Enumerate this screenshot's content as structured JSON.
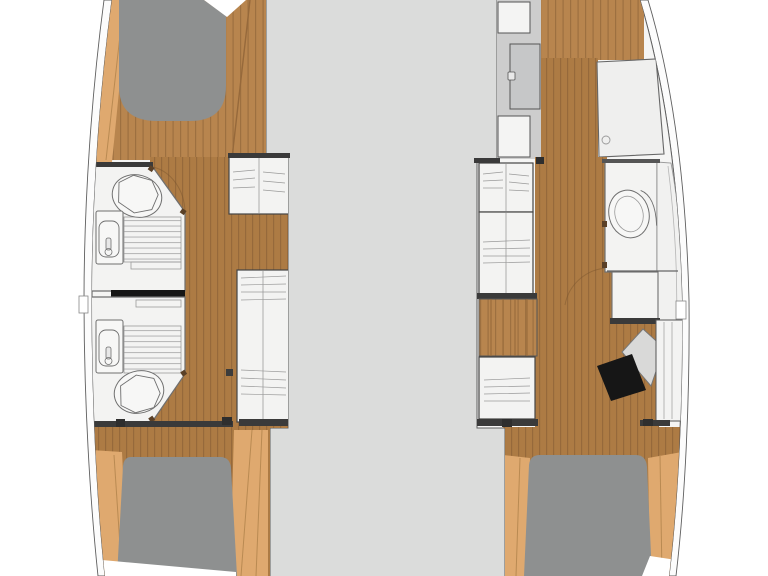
{
  "document": {
    "kind": "boat-floorplan",
    "description": "Top-down interior layout plan of a catamaran: two hulls with cabins and bathrooms flanking a central deck; no text labels are rendered in the drawing"
  },
  "palette": {
    "bg": "#ffffff",
    "deck": "#dbdcdb",
    "hullShell": "#fcfcfc",
    "interior": "#f5f5f4",
    "outline": "#5f5f5f",
    "thinLine": "#9a9a9a",
    "woodDark": "#ad7b44",
    "woodDarkLine": "#96693b",
    "woodMid": "#b8854e",
    "woodMidLine": "#9d7040",
    "woodLight": "#dfa96f",
    "woodLightSeam": "#b98a52",
    "furniture": "#f3f3f2",
    "furnitureLine": "#6f6f6f",
    "slatLine": "#b9b9b9",
    "bed": "#8e9090",
    "black": "#161616",
    "darkBar": "#3a3a3a",
    "doorPanel": "#c6c7c8",
    "lockerStrip": "#cdcdcd",
    "hinge": "#5a4027"
  },
  "plan": {
    "deck": {
      "label": "central bridge-deck area between hulls"
    },
    "port_hull": {
      "rooms": [
        "forward double berth",
        "forward bathroom: toilet, sink, shower",
        "aft bathroom: sink, shower, toilet",
        "two wardrobes on inboard side",
        "aft double berth"
      ]
    },
    "starboard_hull": {
      "rooms": [
        "forward lockers and door",
        "forward shower stall",
        "bathroom with toilet and vanity",
        "wardrobes and companionway steps",
        "chart desk with black seat",
        "aft double berth"
      ]
    }
  }
}
